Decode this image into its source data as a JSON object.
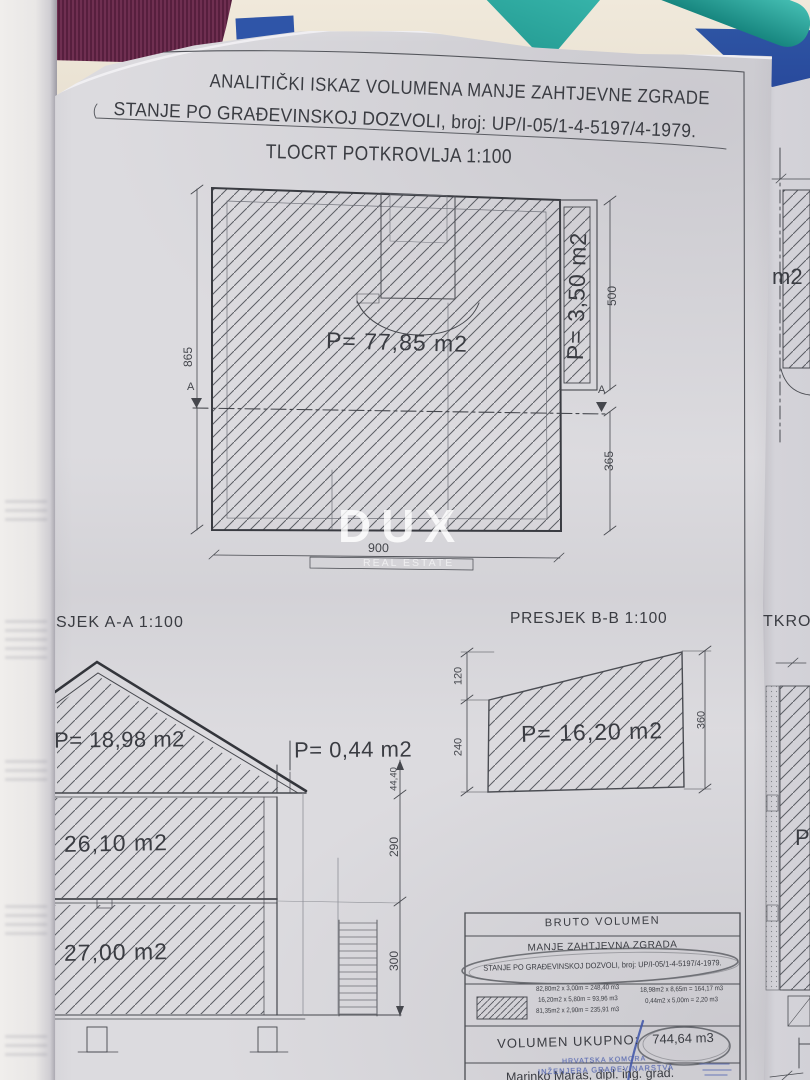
{
  "document": {
    "title_line1": "ANALITIČKI ISKAZ VOLUMENA MANJE ZAHTJEVNE ZGRADE",
    "title_line2": "STANJE PO GRAĐEVINSKOJ DOZVOLI, broj: UP/I-05/1-4-5197/4-1979.",
    "plan": {
      "title": "TLOCRT POTKROVLJA 1:100",
      "area_label": "P= 77,85 m2",
      "side_area_label": "P= 3,50 m2",
      "dim_left": "865",
      "dim_bottom": "900",
      "dim_right_top": "500",
      "dim_right_bottom": "365",
      "section_marker": "A"
    },
    "section_aa": {
      "title": "SJEK A-A 1:100",
      "roof_area": "P= 18,98 m2",
      "eave_area": "P= 0,44 m2",
      "upper_area": "26,10 m2",
      "lower_area": "27,00 m2",
      "dim_top": "44,40",
      "dim_mid": "290",
      "dim_bottom": "300"
    },
    "section_bb": {
      "title": "PRESJEK B-B 1:100",
      "area": "P= 16,20 m2",
      "dim_left_top": "120",
      "dim_left_bottom": "240",
      "dim_right": "360"
    },
    "table": {
      "header": "BRUTO VOLUMEN",
      "row2": "MANJE ZAHTJEVNA ZGRADA",
      "row3": "STANJE PO GRAĐEVINSKOJ DOZVOLI, broj: UP/I-05/1-4-5197/4-1979.",
      "calc_col1": [
        "82,80m2 x 3,00m = 248,40 m3",
        "16,20m2 x 5,80m = 93,96 m3",
        "81,35m2 x 2,90m = 235,91 m3"
      ],
      "calc_col2": [
        "18,98m2 x 8,65m = 164,17 m3",
        "0,44m2 x 5,00m = 2,20 m3"
      ],
      "total_label": "VOLUMEN UKUPNO:",
      "total_value": "744,64 m3",
      "signature": "Marinko Maras, dipl. ing. grad.",
      "stamp_line1": "HRVATSKA KOMORA",
      "stamp_line2": "INŽENJERA GRAĐEVINARSTVA"
    },
    "adjacent_sheet": {
      "partial_title": "TKROV",
      "partial_label_m2": "m2",
      "partial_label_p": "P="
    },
    "watermark": {
      "line1": "DUX",
      "line2": "REAL ESTATE"
    }
  },
  "colors": {
    "paper": "#dcdbdf",
    "ink": "#3a3c42",
    "pen_annotation": "#65676d",
    "blue_pen": "#3d54a8",
    "stamp_blue": "#4c5fae",
    "fabric_purple": "#6f2f51",
    "desk_cream": "#ebe3d4",
    "teal_object": "#2aa69e",
    "book_blue": "#2e55a4",
    "watermark_white": "#ffffff"
  }
}
